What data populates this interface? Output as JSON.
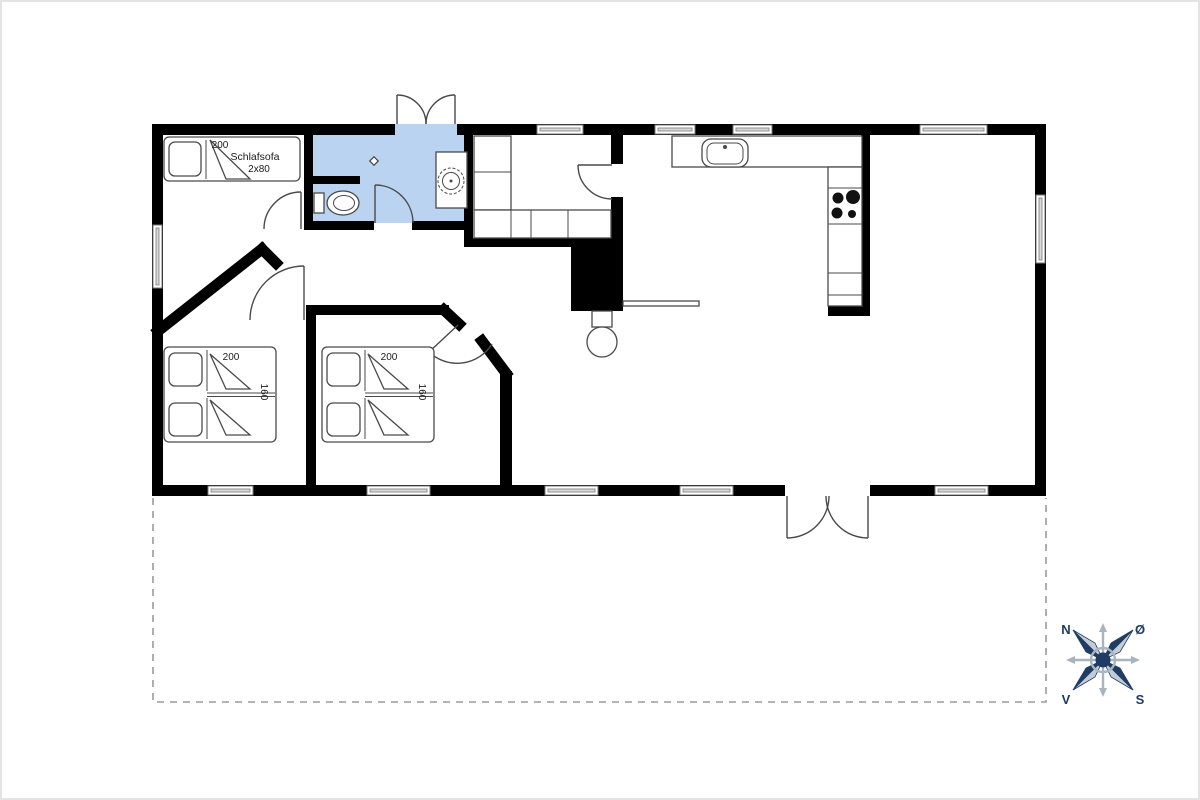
{
  "colors": {
    "wall": "#000000",
    "bath": "#b9d3f1",
    "line": "#4a4a4a",
    "winpane": "#d9d9d9",
    "dash": "#9b9b9b",
    "navy": "#1e3c64",
    "clight": "#c3ccd4",
    "cgray": "#a8b4bf",
    "text": "#1a1a1a"
  },
  "sleep_sofa": {
    "length": "200",
    "label": "Schlafsofa",
    "size": "2x80"
  },
  "bed1": {
    "length": "200",
    "width": "160"
  },
  "bed2": {
    "length": "200",
    "width": "160"
  },
  "compass": {
    "n": "N",
    "oe": "Ø",
    "s": "S",
    "v": "V"
  }
}
